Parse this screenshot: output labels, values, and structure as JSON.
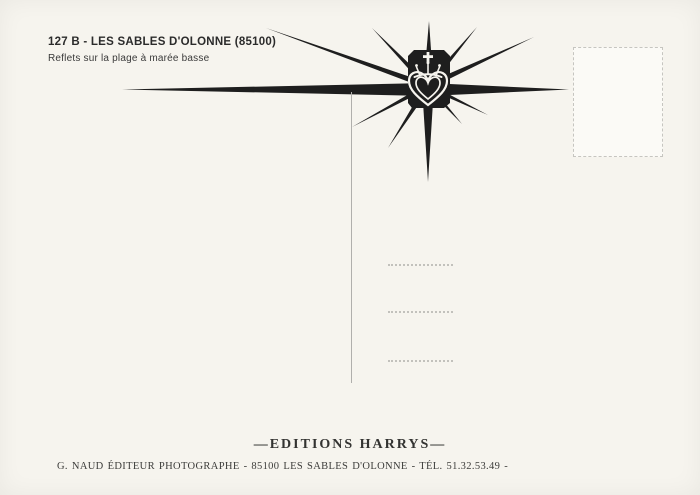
{
  "card": {
    "background_color": "#f6f4ee",
    "ink_color": "#1e1e1e",
    "rule_color": "#b0afac",
    "dotted_color": "#c2c1bc"
  },
  "header": {
    "reference": "127 B - LES SABLES D'OLONNE (85100)",
    "caption": "Reflets sur la plage à marée basse"
  },
  "emblem": {
    "icon": "crowned-heart-starburst-icon"
  },
  "footer": {
    "publisher": "—EDITIONS HARRYS—",
    "credit": "G. NAUD ÉDITEUR PHOTOGRAPHE - 85100 LES SABLES D'OLONNE - TÉL. 51.32.53.49 -"
  }
}
